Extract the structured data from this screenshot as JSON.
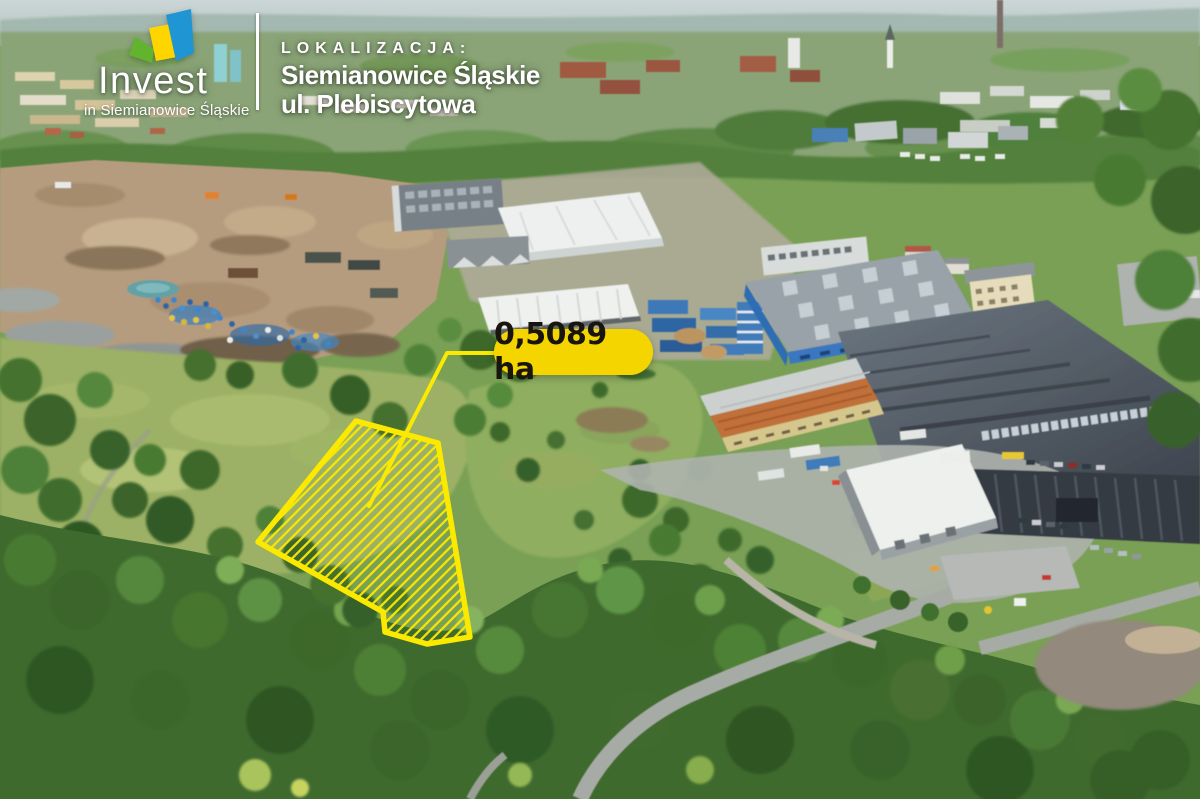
{
  "branding": {
    "logo_title": "Invest",
    "logo_subtitle": "in Siemianowice Śląskie",
    "logo_fan_colors": {
      "green": "#62b32e",
      "yellow": "#ffd500",
      "blue": "#2095d3"
    }
  },
  "location": {
    "heading": "LOKALIZACJA:",
    "city": "Siemianowice Śląskie",
    "street": "ul. Plebiscytowa"
  },
  "plot": {
    "area_label": "0,5089 ha",
    "outline_color": "#fbe900",
    "badge_background": "#f4d500",
    "badge_text_color": "#18150e"
  }
}
